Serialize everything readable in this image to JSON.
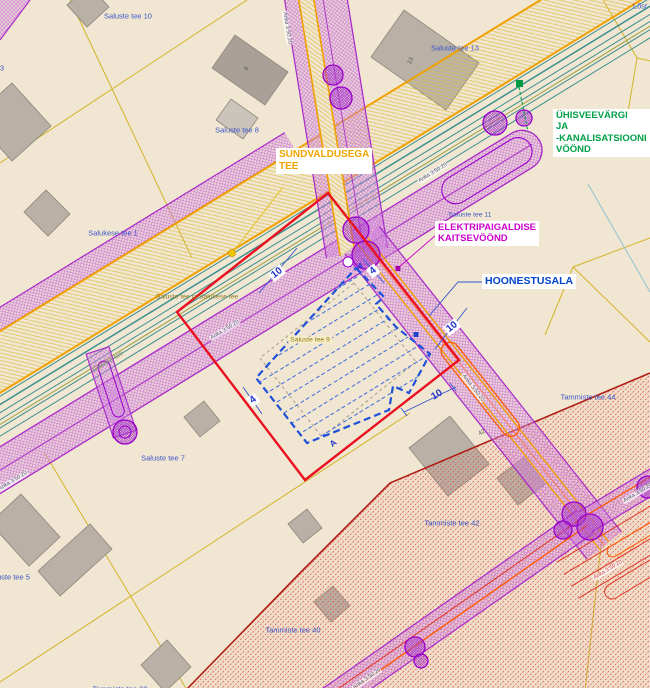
{
  "annotations": {
    "sundvalduse": {
      "line1": "SUNDVALDUSEGA",
      "line2": "TEE"
    },
    "elektri": {
      "line1": "ELEKTRIPAIGALDISE",
      "line2": "KAITSEVÖÖND"
    },
    "hoonestusala": {
      "label": "HOONESTUSALA"
    },
    "uvk": {
      "line1": "ÜHISVEEVÄRGI",
      "line2": "JA",
      "line3": "-KANALISATSIOONI",
      "line4": "VÖÖND"
    }
  },
  "parcels": {
    "saluste10": "Saluste tee 10",
    "saluste13": "Saluste tee 13",
    "saluste8": "Saluste tee 8",
    "salukese1": "Salukese tee 1",
    "saluste11": "Saluste tee 11",
    "saluste9": "Saluste tee 9",
    "saluste7": "Saluste tee 7",
    "saluste5": "Saluste tee 5",
    "saluste3": "3",
    "tammiste44": "Tammiste tee 44",
    "tammiste42": "Tammiste tee 42",
    "tammiste40": "Tammiste tee 40",
    "tammiste38": "Tammiste tee 38",
    "corner_ne": "Lõst"
  },
  "roads": {
    "combined": "Saluste tee ja Salukese tee",
    "saluste": "Saluste tee",
    "corridor_code": "Anka 3:50:20"
  },
  "dimensions": {
    "ten": "10",
    "four": "4",
    "section_a": "A"
  },
  "buildings": {
    "b13": "13",
    "b42": "42",
    "b8": "8"
  },
  "colors": {
    "background": "#f1e6d1",
    "annotation_orange": "#f0a400",
    "annotation_magenta": "#cc00cc",
    "annotation_blue": "#0044cc",
    "annotation_green": "#009944",
    "parcel_label_blue": "#3a55c8",
    "zone_purple": "#a829c8",
    "road_orange": "#f0a000",
    "water_teal": "#3a9090",
    "plan_red": "#ea1020",
    "hoonestusala_blue": "#1e50d8",
    "restriction_red_hatch": "#d85040"
  }
}
